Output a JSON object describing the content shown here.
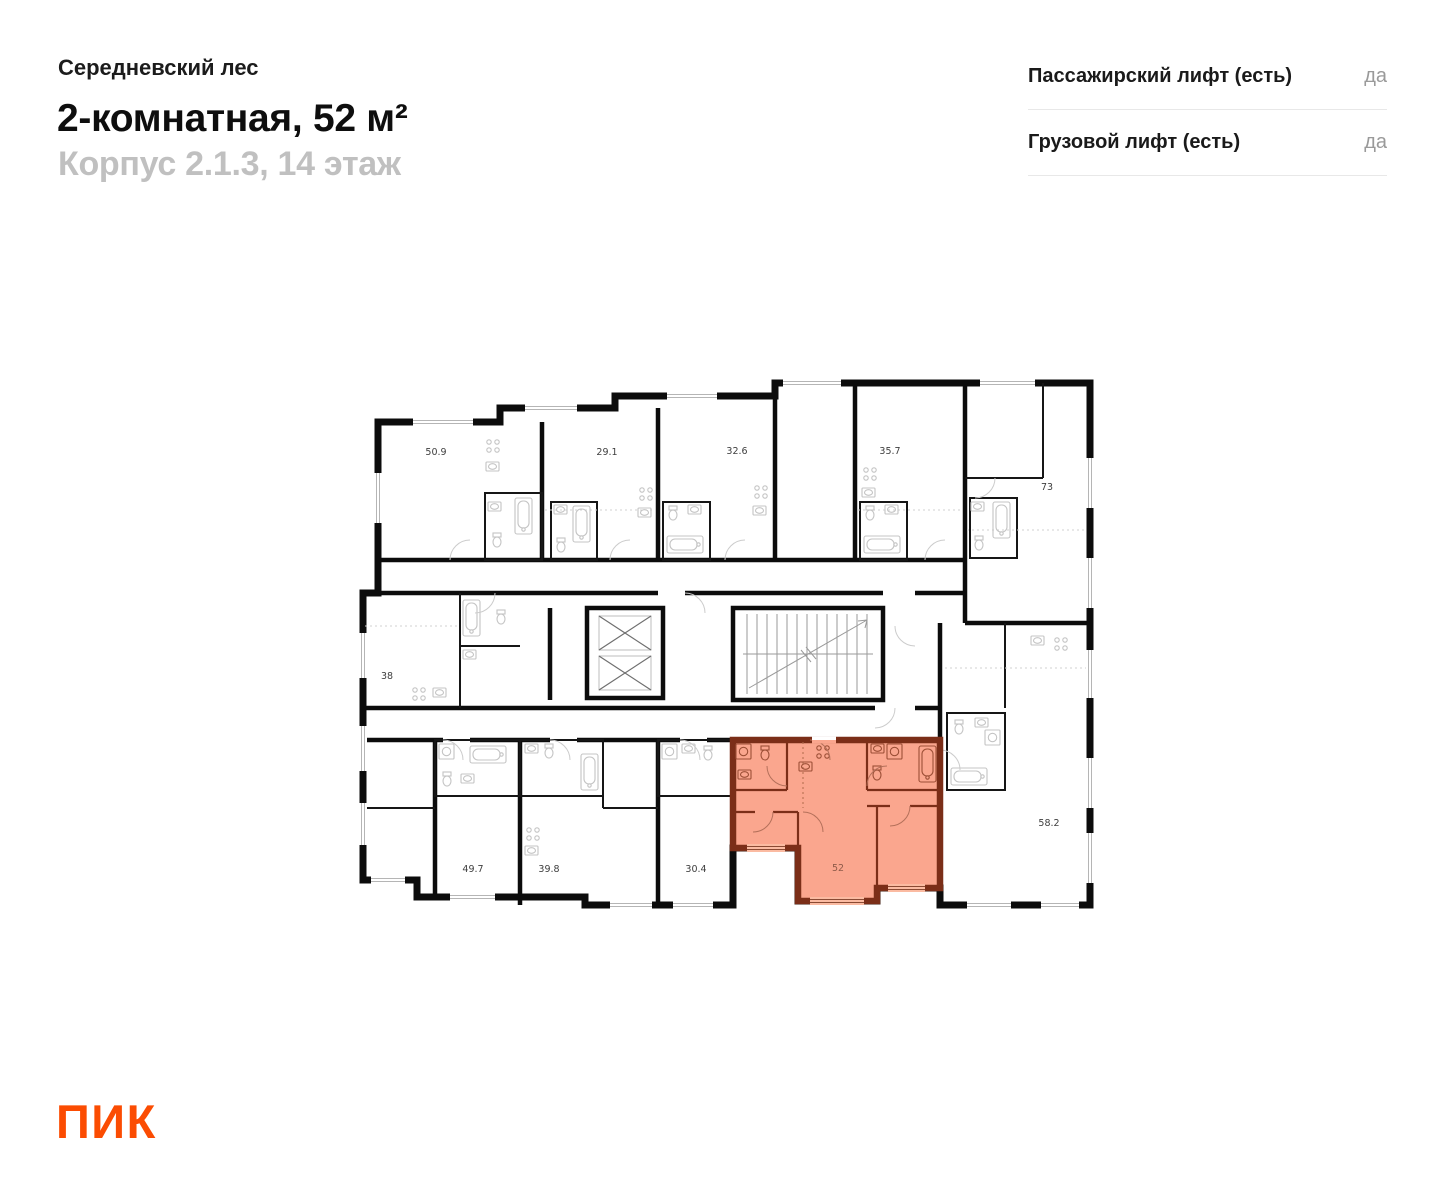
{
  "header": {
    "project": "Середневский лес",
    "title": "2-комнатная, 52 м²",
    "subtitle": "Корпус 2.1.3, 14 этаж"
  },
  "lift_info": {
    "rows": [
      {
        "label": "Пассажирский лифт (есть)",
        "value": "да"
      },
      {
        "label": "Грузовой лифт (есть)",
        "value": "да"
      }
    ]
  },
  "logo": {
    "text": "ПИК",
    "color": "#FB4C02"
  },
  "floorplan": {
    "highlighted_unit": {
      "area": "52",
      "fill": "#FAA68E",
      "wall": "#7B2E18"
    },
    "units": [
      {
        "area": "50.9"
      },
      {
        "area": "29.1"
      },
      {
        "area": "32.6"
      },
      {
        "area": "35.7"
      },
      {
        "area": "73"
      },
      {
        "area": "38"
      },
      {
        "area": "49.7"
      },
      {
        "area": "39.8"
      },
      {
        "area": "30.4"
      },
      {
        "area": "58.2"
      }
    ],
    "colors": {
      "wall": "#0c0c0c",
      "fixture": "#c4c4c4"
    }
  }
}
